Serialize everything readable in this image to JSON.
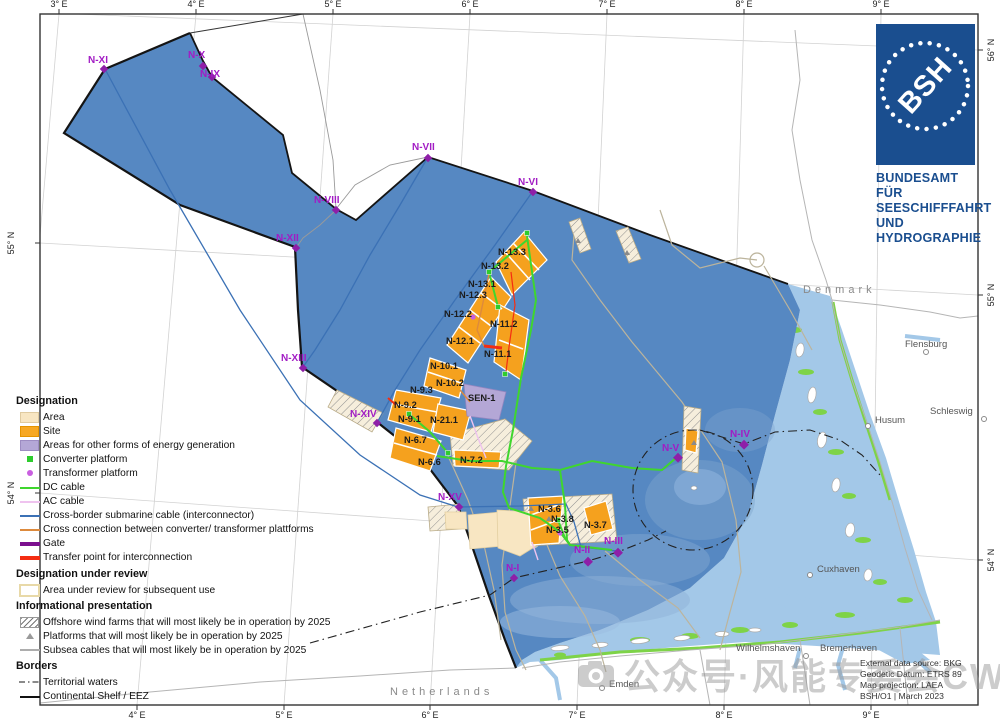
{
  "axes": {
    "top": [
      "3° E",
      "4° E",
      "5° E",
      "6° E",
      "7° E",
      "8° E",
      "9° E"
    ],
    "bottom": [
      "4° E",
      "5° E",
      "6° E",
      "7° E",
      "8° E",
      "9° E"
    ],
    "left": [
      "55° N",
      "54° N"
    ],
    "right": [
      "56° N",
      "55° N",
      "54° N"
    ]
  },
  "regions": {
    "denmark": "Denmark",
    "netherlands": "Netherlands"
  },
  "cities": [
    {
      "name": "Flensburg"
    },
    {
      "name": "Schleswig"
    },
    {
      "name": "Husum"
    },
    {
      "name": "Cuxhaven"
    },
    {
      "name": "Wilhelmshaven"
    },
    {
      "name": "Bremerhaven"
    },
    {
      "name": "Emden"
    }
  ],
  "sites": [
    {
      "id": "N-13.3"
    },
    {
      "id": "N-13.2"
    },
    {
      "id": "N-13.1"
    },
    {
      "id": "N-12.3"
    },
    {
      "id": "N-12.2"
    },
    {
      "id": "N-11.2"
    },
    {
      "id": "N-12.1"
    },
    {
      "id": "N-11.1"
    },
    {
      "id": "N-10.1"
    },
    {
      "id": "N-10.2"
    },
    {
      "id": "N-9.3"
    },
    {
      "id": "N-9.2"
    },
    {
      "id": "N-9.1"
    },
    {
      "id": "N-21.1"
    },
    {
      "id": "N-6.7"
    },
    {
      "id": "N-6.6"
    },
    {
      "id": "N-7.2"
    },
    {
      "id": "N-3.6"
    },
    {
      "id": "N-3.8"
    },
    {
      "id": "N-3.7"
    },
    {
      "id": "N-3.5"
    },
    {
      "id": "SEN-1"
    }
  ],
  "gates": [
    {
      "id": "N-XI"
    },
    {
      "id": "N-X"
    },
    {
      "id": "N-IX"
    },
    {
      "id": "N-VII"
    },
    {
      "id": "N-VI"
    },
    {
      "id": "N-VIII"
    },
    {
      "id": "N-XII"
    },
    {
      "id": "N-XIII"
    },
    {
      "id": "N-XIV"
    },
    {
      "id": "N-XV"
    },
    {
      "id": "N-V"
    },
    {
      "id": "N-IV"
    },
    {
      "id": "N-I"
    },
    {
      "id": "N-II"
    },
    {
      "id": "N-III"
    }
  ],
  "legend": {
    "sections": [
      {
        "title": "Designation",
        "items": [
          {
            "label": "Area"
          },
          {
            "label": "Site"
          },
          {
            "label": "Areas for other forms of energy generation"
          },
          {
            "label": "Converter platform"
          },
          {
            "label": "Transformer platform"
          },
          {
            "label": "DC cable"
          },
          {
            "label": "AC cable"
          },
          {
            "label": "Cross-border submarine cable (interconnector)"
          },
          {
            "label": "Cross connection between converter/ transformer plattforms"
          },
          {
            "label": "Gate"
          },
          {
            "label": "Transfer point for interconnection"
          }
        ]
      },
      {
        "title": "Designation under review",
        "items": [
          {
            "label": "Area under review for subsequent use"
          }
        ]
      },
      {
        "title": "Informational presentation",
        "items": [
          {
            "label": "Offshore wind farms that will most likely be in operation by 2025"
          },
          {
            "label": "Platforms that will most likely be in operation by 2025"
          },
          {
            "label": "Subsea cables that will most likely be in operation by 2025"
          }
        ]
      },
      {
        "title": "Borders",
        "items": [
          {
            "label": "Territorial waters"
          },
          {
            "label": "Continental Shelf / EEZ"
          }
        ]
      }
    ]
  },
  "logo": {
    "acronym": "BSH",
    "lines": [
      "BUNDESAMT FÜR",
      "SEESCHIFFFAHRT",
      "UND",
      "HYDROGRAPHIE"
    ]
  },
  "credits": {
    "lines": [
      "External data source: BKG",
      "Geodetic Datum: ETRS 89",
      "Map projection: LAEA",
      "BSH/O1 | March 2023"
    ]
  },
  "watermark": {
    "text": "公众号·风能专委会CWEA"
  },
  "colors": {
    "eez_blue": "#5688C2",
    "coastal_blue": "#A3C8E8",
    "tidal_green": "#7ED348",
    "site_orange": "#F5A11E",
    "area_beige": "#F8E6C2",
    "other_energy_purple": "#B4A7D6",
    "dc_cable_green": "#3FD62E",
    "ac_cable_pink": "#EFC3EF",
    "interconnector_blue": "#3B71B5",
    "cross_connection_orange": "#DD8A3C",
    "gate_purple": "#7B0F8E",
    "transfer_red": "#F42D12",
    "bsh_blue": "#1A4E8F"
  }
}
